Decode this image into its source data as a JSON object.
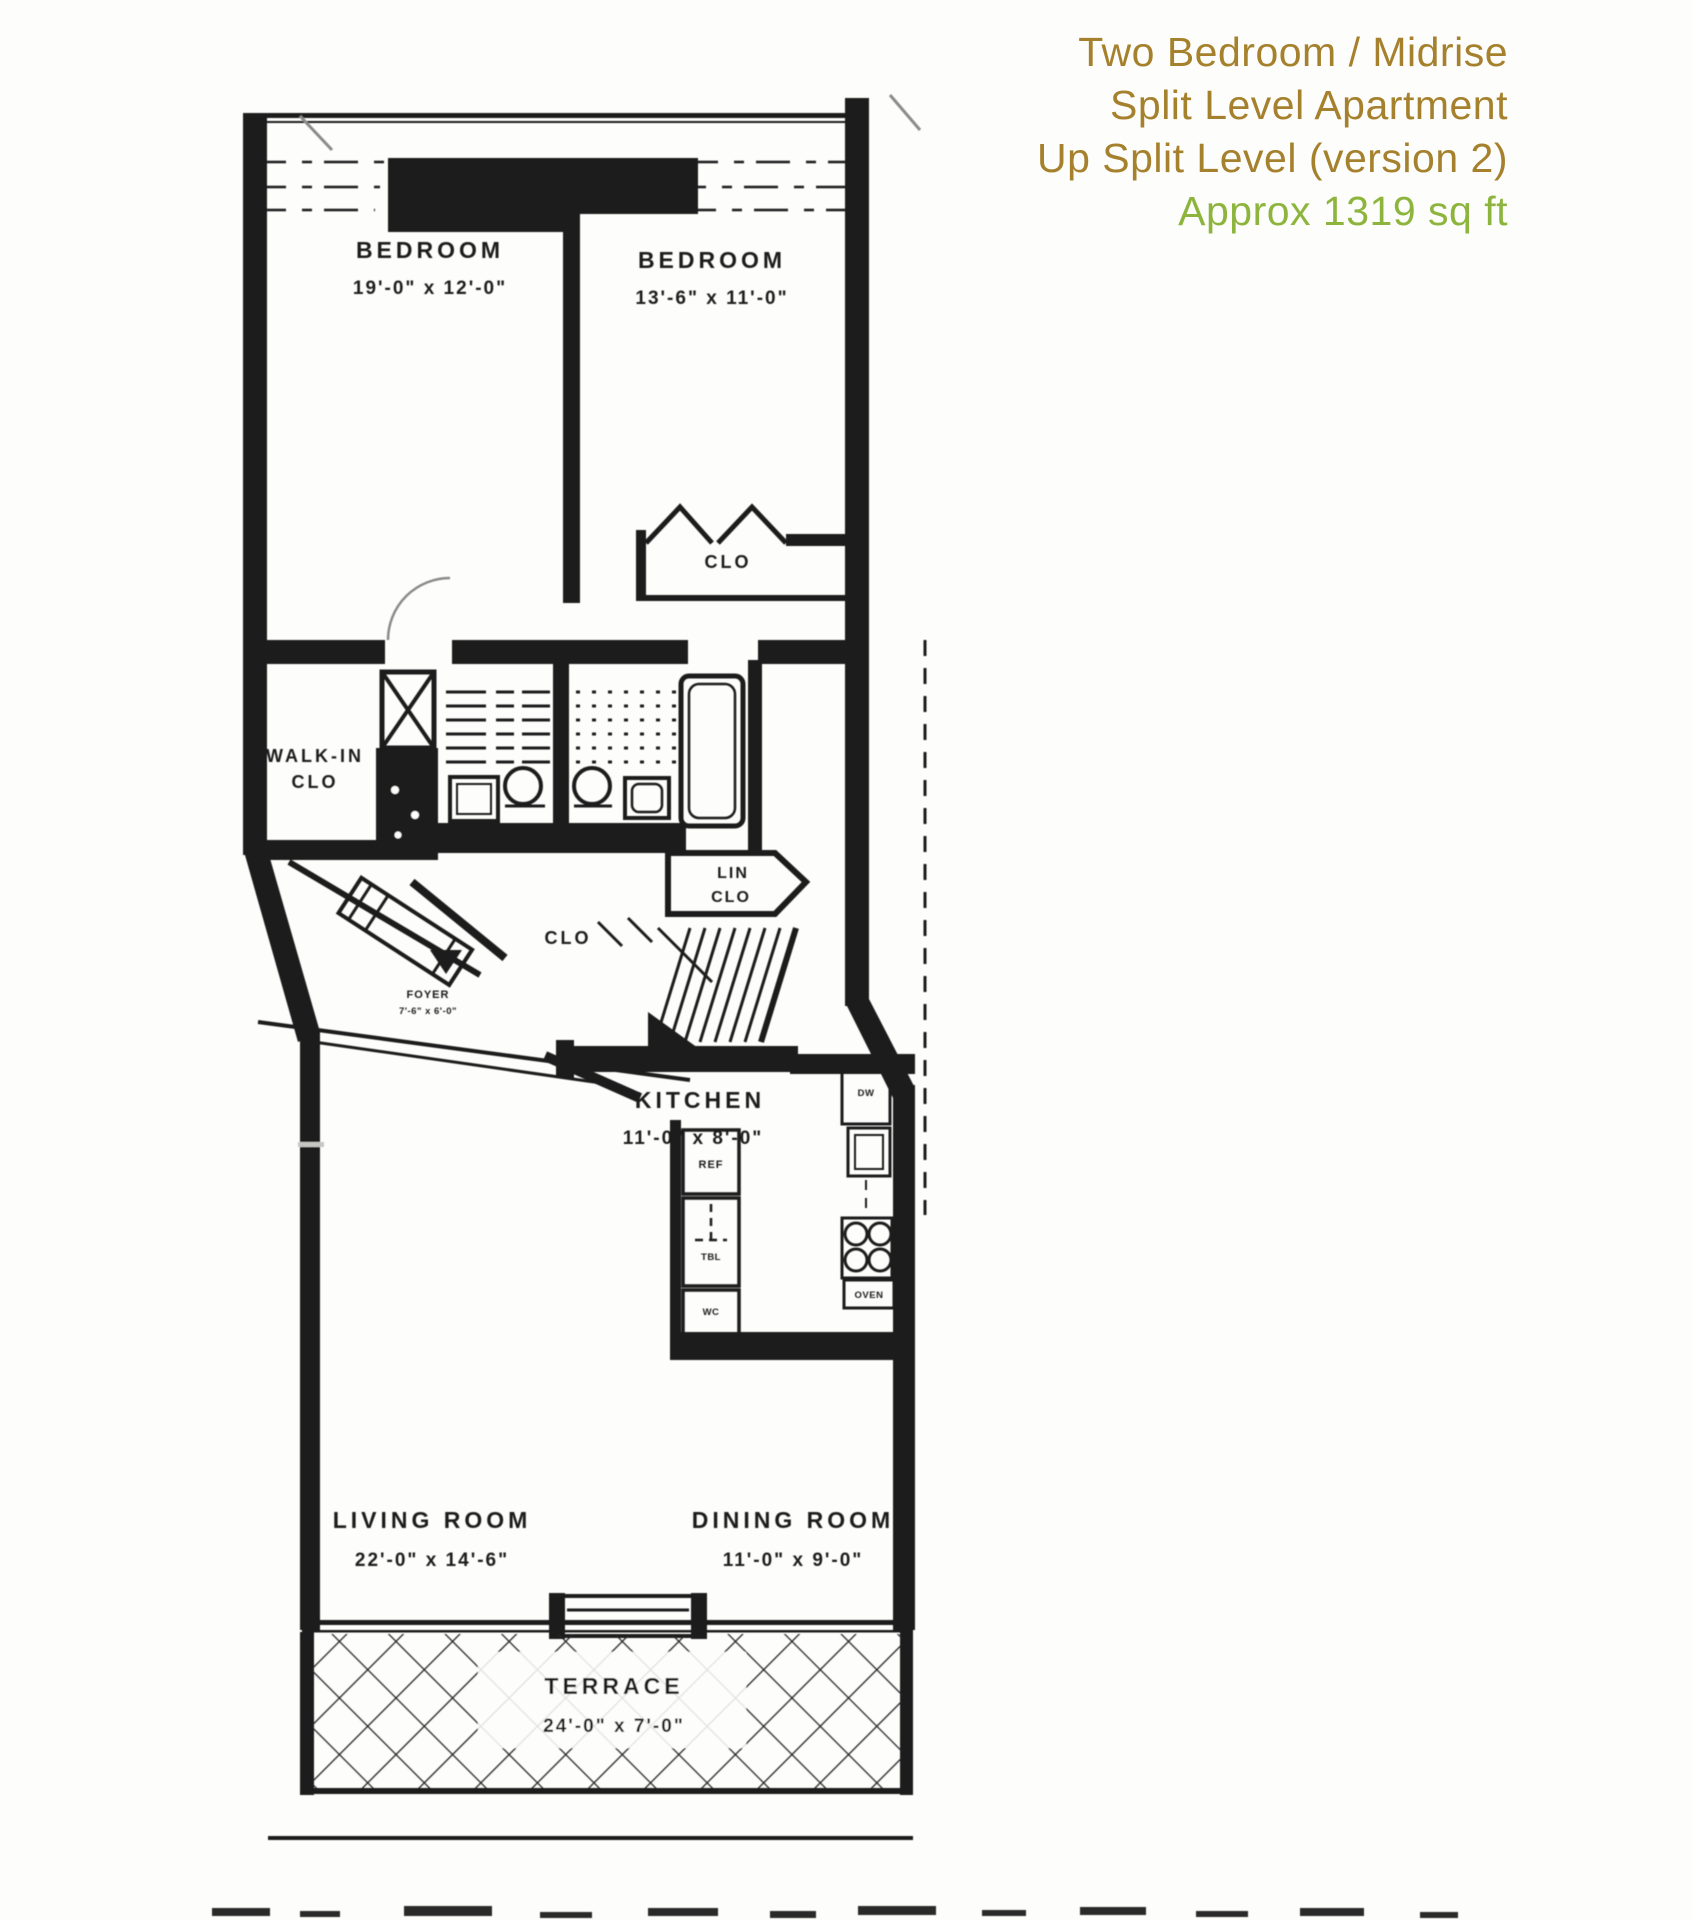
{
  "title": {
    "line1": "Two Bedroom / Midrise",
    "line2": "Split Level Apartment",
    "line3": "Up Split Level (version 2)",
    "line4": "Approx 1319 sq ft"
  },
  "colors": {
    "title_brown": "#a6812d",
    "title_green": "#8db53e",
    "ink": "#1b1b1b",
    "background": "#fdfdfb"
  },
  "plan": {
    "rooms": {
      "bedroom1": {
        "name": "BEDROOM",
        "dims": "19'-0\" x 12'-0\""
      },
      "bedroom2": {
        "name": "BEDROOM",
        "dims": "13'-6\" x 11'-0\""
      },
      "kitchen": {
        "name": "KITCHEN",
        "dims": "11'-0\" x 8'-0\""
      },
      "living_room": {
        "name": "LIVING ROOM",
        "dims": "22'-0\" x 14'-6\""
      },
      "dining_room": {
        "name": "DINING ROOM",
        "dims": "11'-0\" x 9'-0\""
      },
      "terrace": {
        "name": "TERRACE",
        "dims": "24'-0\" x 7'-0\""
      },
      "foyer": {
        "name": "FOYER",
        "dims": "7'-6\" x 6'-0\""
      }
    },
    "closets": {
      "bedroom_closet": "CLO",
      "walk_in_line1": "WALK-IN",
      "walk_in_line2": "CLO",
      "linen_line1": "LIN",
      "linen_line2": "CLO",
      "hall_closet": "CLO"
    },
    "appliances": {
      "refrigerator": "REF",
      "table": "TBL",
      "wc": "WC",
      "dishwasher": "DW",
      "oven": "OVEN"
    }
  }
}
